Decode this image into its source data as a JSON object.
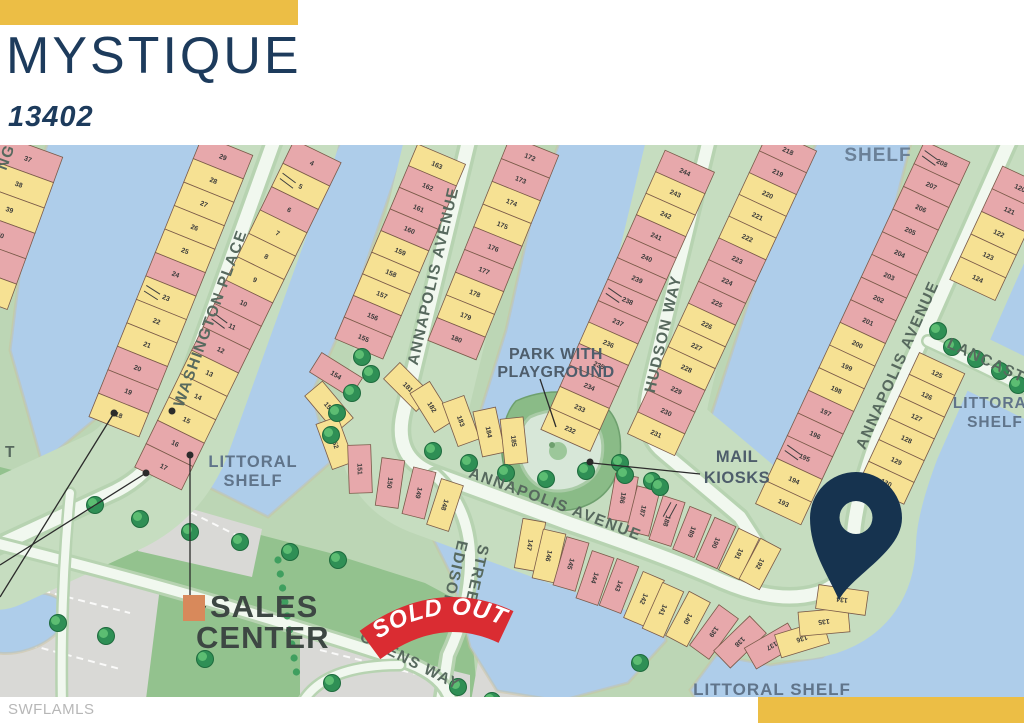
{
  "header": {
    "title": "MYSTIQUE",
    "subtitle": "13402"
  },
  "footer": {
    "watermark": "SWFLAMLS"
  },
  "colors": {
    "gold": "#ecbe45",
    "navy": "#1d3b5c",
    "pin": "#16334f",
    "pink": "#e7a8ab",
    "yellow": "#f6e193",
    "water": "#aecdea",
    "tree_dark": "#2f8f55",
    "tree_light": "#5cbd72",
    "ribbon_red": "#da2c32"
  },
  "map": {
    "streets": {
      "washington": "WASHINGTON PLACE",
      "annapolis": "ANNAPOLIS AVENUE",
      "hudson": "HUDSON WAY",
      "edison_lines": [
        "EDISON",
        "STREET"
      ],
      "owens": "OWENS WAY",
      "lancaster": "LANCASTER"
    },
    "labels": {
      "park_lines": [
        "PARK WITH",
        "PLAYGROUND"
      ],
      "mail_lines": [
        "MAIL",
        "KIOSKS"
      ],
      "sales_lines": [
        "SALES",
        "CENTER"
      ],
      "littoral_lines": [
        "LITTORAL",
        "SHELF"
      ],
      "littoral_single": "LITTORAL SHELF",
      "shelf_fragment": "SHELF",
      "sold_out": "SOLD OUT",
      "edge_fragments": [
        "NG",
        "T"
      ]
    },
    "pin_lot": "134",
    "blocks": {
      "farleft": [
        {
          "n": "37",
          "c": "p"
        },
        {
          "n": "38",
          "c": "y"
        },
        {
          "n": "39",
          "c": "y"
        },
        {
          "n": "40",
          "c": "p"
        },
        {
          "n": "41",
          "c": "p"
        },
        {
          "n": "42",
          "c": "y"
        }
      ],
      "wash_w": [
        {
          "n": "29",
          "c": "p"
        },
        {
          "n": "28",
          "c": "y"
        },
        {
          "n": "27",
          "c": "y"
        },
        {
          "n": "26",
          "c": "y"
        },
        {
          "n": "25",
          "c": "y"
        },
        {
          "n": "24",
          "c": "p"
        },
        {
          "n": "23",
          "c": "y",
          "h": true
        },
        {
          "n": "22",
          "c": "y"
        },
        {
          "n": "21",
          "c": "y"
        },
        {
          "n": "20",
          "c": "p"
        },
        {
          "n": "19",
          "c": "p"
        },
        {
          "n": "18",
          "c": "y"
        }
      ],
      "wash_e": [
        {
          "n": "4",
          "c": "p"
        },
        {
          "n": "5",
          "c": "y",
          "h": true
        },
        {
          "n": "6",
          "c": "p"
        },
        {
          "n": "7",
          "c": "y"
        },
        {
          "n": "8",
          "c": "y"
        },
        {
          "n": "9",
          "c": "y"
        },
        {
          "n": "10",
          "c": "p"
        },
        {
          "n": "11",
          "c": "p",
          "h": true
        },
        {
          "n": "12",
          "c": "p"
        },
        {
          "n": "13",
          "c": "y"
        },
        {
          "n": "14",
          "c": "y"
        },
        {
          "n": "15",
          "c": "y"
        },
        {
          "n": "16",
          "c": "p"
        },
        {
          "n": "17",
          "c": "p"
        }
      ],
      "annl_w": [
        {
          "n": "163",
          "c": "y"
        },
        {
          "n": "162",
          "c": "p"
        },
        {
          "n": "161",
          "c": "p"
        },
        {
          "n": "160",
          "c": "p"
        },
        {
          "n": "159",
          "c": "y"
        },
        {
          "n": "158",
          "c": "y"
        },
        {
          "n": "157",
          "c": "y"
        },
        {
          "n": "156",
          "c": "p"
        },
        {
          "n": "155",
          "c": "p"
        }
      ],
      "annl_fan": [
        {
          "n": "154",
          "c": "p"
        },
        {
          "n": "153",
          "c": "y"
        },
        {
          "n": "152",
          "c": "y"
        },
        {
          "n": "151",
          "c": "p"
        },
        {
          "n": "150",
          "c": "p"
        },
        {
          "n": "149",
          "c": "p"
        },
        {
          "n": "148",
          "c": "y"
        }
      ],
      "annl_e": [
        {
          "n": "172",
          "c": "p"
        },
        {
          "n": "173",
          "c": "p"
        },
        {
          "n": "174",
          "c": "y"
        },
        {
          "n": "175",
          "c": "y"
        },
        {
          "n": "176",
          "c": "p"
        },
        {
          "n": "177",
          "c": "p"
        },
        {
          "n": "178",
          "c": "y"
        },
        {
          "n": "179",
          "c": "y"
        },
        {
          "n": "180",
          "c": "p"
        }
      ],
      "annl_corner": [
        {
          "n": "181",
          "c": "y"
        },
        {
          "n": "182",
          "c": "y"
        },
        {
          "n": "183",
          "c": "y"
        },
        {
          "n": "184",
          "c": "y"
        },
        {
          "n": "185",
          "c": "y"
        }
      ],
      "hud_w": [
        {
          "n": "244",
          "c": "p"
        },
        {
          "n": "243",
          "c": "y"
        },
        {
          "n": "242",
          "c": "y"
        },
        {
          "n": "241",
          "c": "p"
        },
        {
          "n": "240",
          "c": "p"
        },
        {
          "n": "239",
          "c": "p"
        },
        {
          "n": "238",
          "c": "p",
          "h": true
        },
        {
          "n": "237",
          "c": "p"
        },
        {
          "n": "236",
          "c": "y"
        },
        {
          "n": "235",
          "c": "p"
        },
        {
          "n": "234",
          "c": "p"
        },
        {
          "n": "233",
          "c": "y"
        },
        {
          "n": "232",
          "c": "y"
        }
      ],
      "hud_e": [
        {
          "n": "218",
          "c": "p"
        },
        {
          "n": "219",
          "c": "p"
        },
        {
          "n": "220",
          "c": "y"
        },
        {
          "n": "221",
          "c": "y"
        },
        {
          "n": "222",
          "c": "y"
        },
        {
          "n": "223",
          "c": "p"
        },
        {
          "n": "224",
          "c": "p"
        },
        {
          "n": "225",
          "c": "p"
        },
        {
          "n": "226",
          "c": "y"
        },
        {
          "n": "227",
          "c": "y"
        },
        {
          "n": "228",
          "c": "y"
        },
        {
          "n": "229",
          "c": "p"
        },
        {
          "n": "230",
          "c": "p"
        },
        {
          "n": "231",
          "c": "y"
        }
      ],
      "annr_w": [
        {
          "n": "208",
          "c": "p",
          "h": true
        },
        {
          "n": "207",
          "c": "p"
        },
        {
          "n": "206",
          "c": "p"
        },
        {
          "n": "205",
          "c": "p"
        },
        {
          "n": "204",
          "c": "p"
        },
        {
          "n": "203",
          "c": "p"
        },
        {
          "n": "202",
          "c": "p"
        },
        {
          "n": "201",
          "c": "p"
        },
        {
          "n": "200",
          "c": "y"
        },
        {
          "n": "199",
          "c": "y"
        },
        {
          "n": "198",
          "c": "y"
        },
        {
          "n": "197",
          "c": "p"
        },
        {
          "n": "196",
          "c": "p"
        },
        {
          "n": "195",
          "c": "p",
          "h": true
        },
        {
          "n": "194",
          "c": "y"
        },
        {
          "n": "193",
          "c": "y"
        }
      ],
      "annr_corner": [
        {
          "n": "186",
          "c": "p"
        },
        {
          "n": "187",
          "c": "p"
        },
        {
          "n": "188",
          "c": "p",
          "h": true
        },
        {
          "n": "189",
          "c": "p"
        },
        {
          "n": "190",
          "c": "p"
        },
        {
          "n": "191",
          "c": "y"
        },
        {
          "n": "192",
          "c": "y"
        }
      ],
      "annr_e": [
        {
          "n": "120",
          "c": "p"
        },
        {
          "n": "121",
          "c": "p"
        },
        {
          "n": "122",
          "c": "y"
        },
        {
          "n": "123",
          "c": "y"
        },
        {
          "n": "124",
          "c": "y"
        }
      ],
      "annr_mid": [
        {
          "n": "125",
          "c": "y"
        },
        {
          "n": "126",
          "c": "y"
        },
        {
          "n": "127",
          "c": "y"
        },
        {
          "n": "128",
          "c": "y"
        },
        {
          "n": "129",
          "c": "y"
        },
        {
          "n": "130",
          "c": "y"
        }
      ],
      "bottom_row": [
        {
          "n": "147",
          "c": "y"
        },
        {
          "n": "146",
          "c": "y"
        },
        {
          "n": "145",
          "c": "p"
        },
        {
          "n": "144",
          "c": "p"
        },
        {
          "n": "143",
          "c": "p"
        },
        {
          "n": "142",
          "c": "y"
        },
        {
          "n": "141",
          "c": "y"
        }
      ],
      "fan": [
        {
          "n": "140",
          "c": "y"
        },
        {
          "n": "139",
          "c": "p"
        },
        {
          "n": "138",
          "c": "p"
        },
        {
          "n": "137",
          "c": "p"
        },
        {
          "n": "136",
          "c": "y"
        },
        {
          "n": "135",
          "c": "y"
        },
        {
          "n": "134",
          "c": "y"
        }
      ]
    }
  }
}
